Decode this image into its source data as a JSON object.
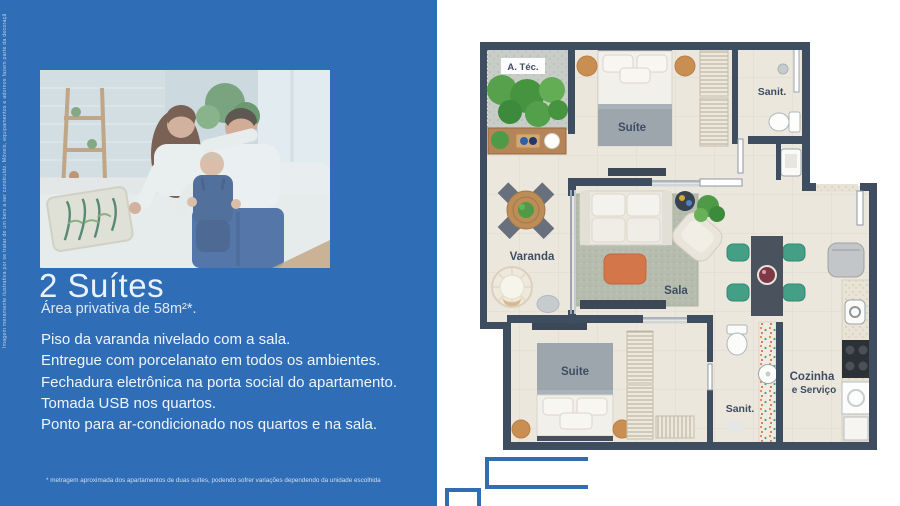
{
  "left_panel": {
    "bg_color": "#2f6eb6",
    "vertical_disclaimer": "Imagem meramente ilustrativa por se tratar de um bem a ser construído. Móveis, equipamentos e adornos fazem parte da decoração e não estão inclusos no preço do imóvel.",
    "title": "2 Suítes",
    "subtitle": "Área privativa de 58m²*.",
    "features": [
      "Piso da varanda nivelado com a sala.",
      "Entregue com porcelanato em todos os ambientes.",
      "Fechadura eletrônica na porta social do apartamento.",
      "Tomada USB nos quartos.",
      "Ponto para ar-condicionado nos quartos e na sala."
    ],
    "footnote": "* metragem aproximada dos apartamentos de duas suítes, podendo sofrer variações dependendo da unidade escolhida"
  },
  "floorplan": {
    "labels": {
      "atec": "A. Téc.",
      "suite_top": "Suíte",
      "sanit_top": "Sanit.",
      "varanda": "Varanda",
      "sala": "Sala",
      "suite_bottom": "Suite",
      "sanit_bottom": "Sanit.",
      "kitchen_line1": "Cozinha",
      "kitchen_line2": "e Serviço"
    },
    "colors": {
      "wall": "#3e4d60",
      "floor": "#ebe7dd",
      "accent_blue": "#2f6eb6"
    }
  }
}
